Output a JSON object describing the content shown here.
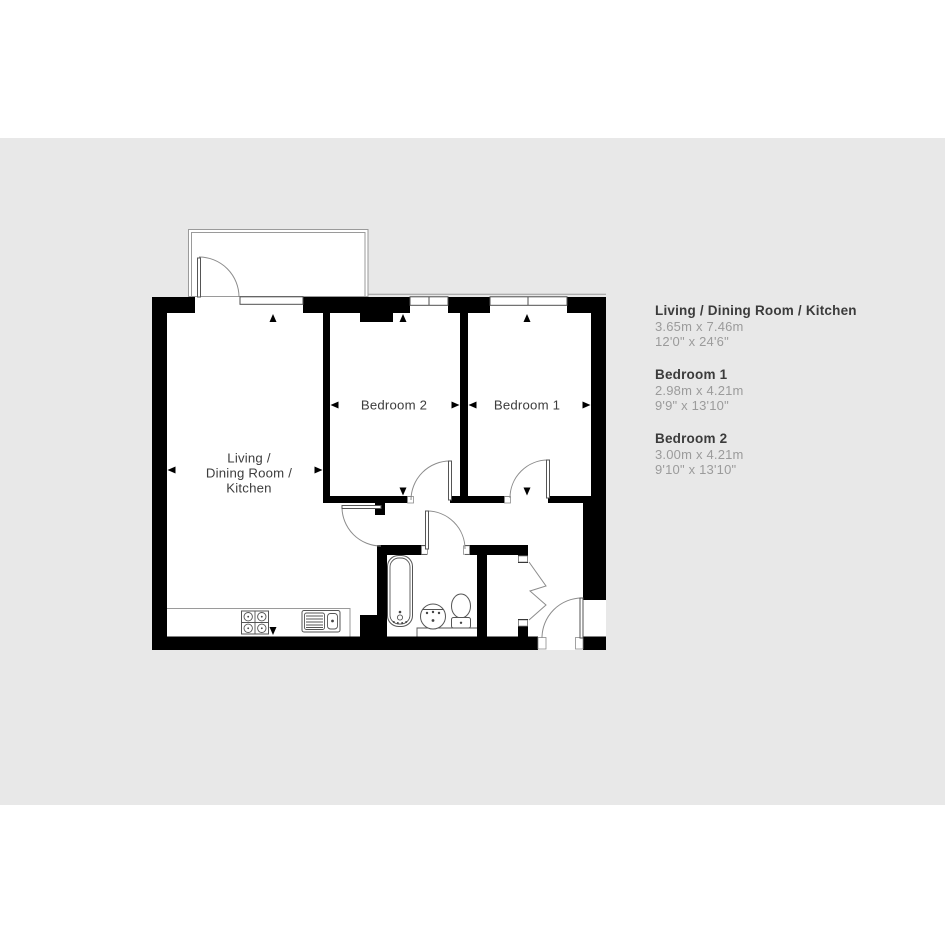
{
  "canvas": {
    "page_color": "#ffffff",
    "background_color": "#e8e8e8",
    "wall_color": "#000000",
    "label_color": "#3d3d3d",
    "legend_title_color": "#3b3b3b",
    "legend_dim_color": "#9b9b9b"
  },
  "floorplan": {
    "labels": {
      "living": [
        "Living /",
        "Dining Room /",
        "Kitchen"
      ],
      "bedroom2": "Bedroom 2",
      "bedroom1": "Bedroom 1"
    }
  },
  "legend": {
    "entries": [
      {
        "name": "Living / Dining Room / Kitchen",
        "metric": "3.65m x 7.46m",
        "imperial": "12'0\" x 24'6\""
      },
      {
        "name": "Bedroom 1",
        "metric": "2.98m x 4.21m",
        "imperial": "9'9\" x 13'10\""
      },
      {
        "name": "Bedroom 2",
        "metric": "3.00m x 4.21m",
        "imperial": "9'10\" x 13'10\""
      }
    ]
  }
}
